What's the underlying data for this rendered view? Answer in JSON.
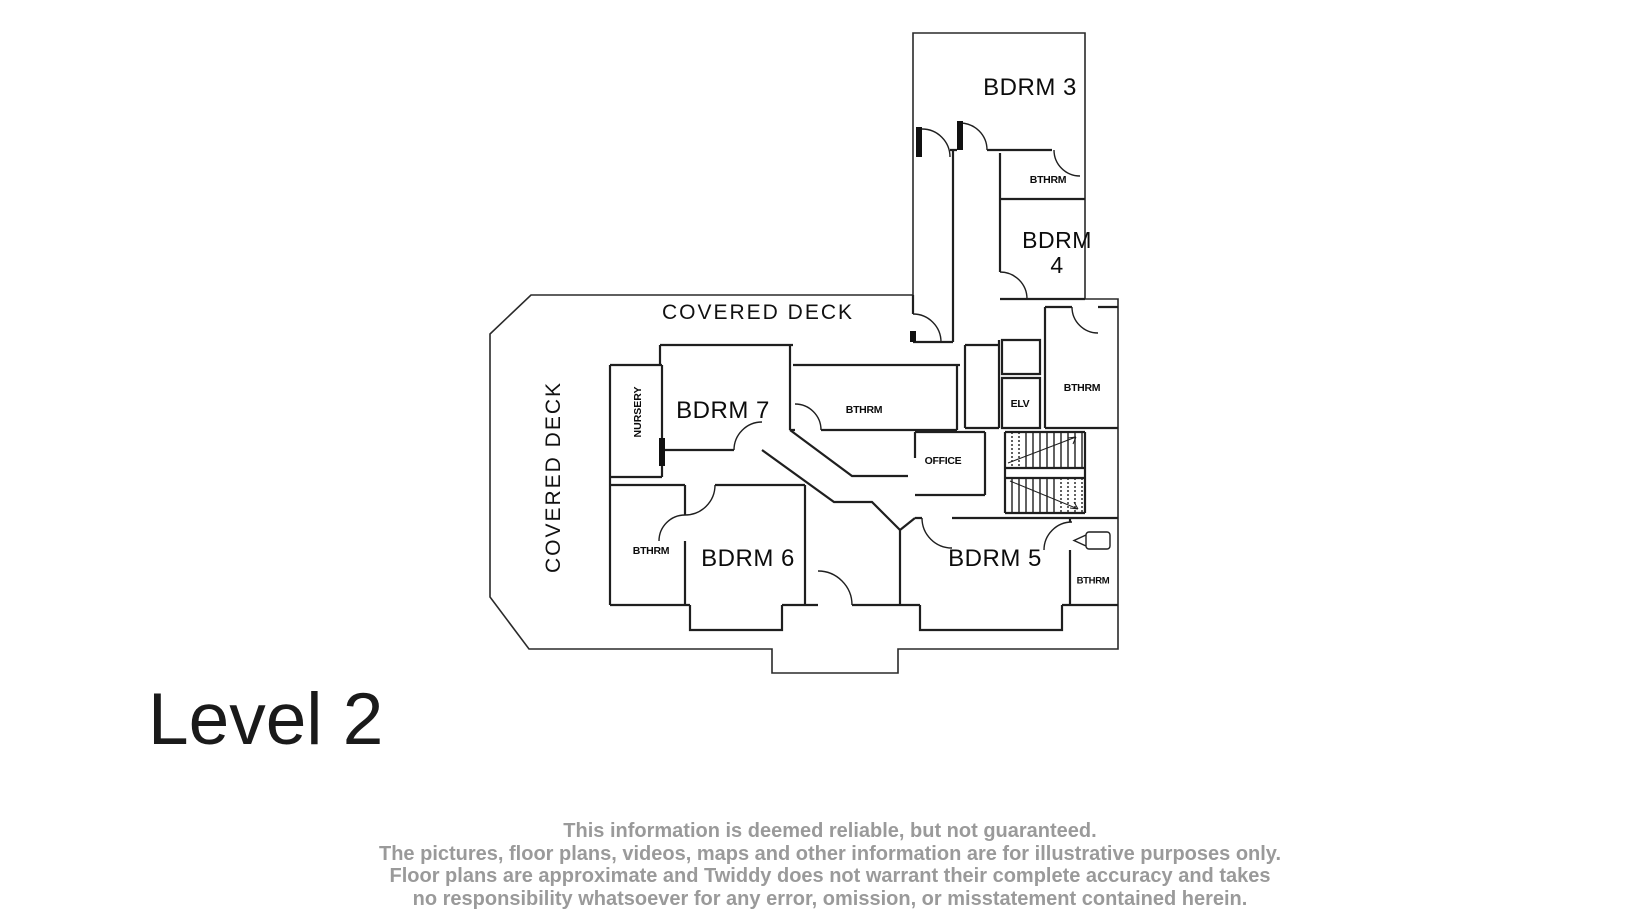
{
  "title": {
    "level_label": "Level 2"
  },
  "floor_plan": {
    "labels": {
      "bdrm3": "BDRM 3",
      "bthrm_top": "BTHRM",
      "bdrm4": "BDRM\n4",
      "elv": "ELV",
      "bthrm_upper_right": "BTHRM",
      "covered_deck_top": "COVERED DECK",
      "covered_deck_left": "COVERED DECK",
      "nursery": "NURSERY",
      "bdrm7": "BDRM 7",
      "bthrm_center": "BTHRM",
      "office": "OFFICE",
      "bthrm_left": "BTHRM",
      "bdrm6": "BDRM 6",
      "bdrm5": "BDRM 5",
      "bthrm_lower_right": "BTHRM"
    },
    "colors": {
      "wall": "#1f1f1f",
      "label": "#0c0c0c",
      "disclaimer_text": "#9a9a9a"
    }
  },
  "disclaimer": {
    "line1": "This information is deemed reliable, but not guaranteed.",
    "line2": "The pictures, floor plans, videos, maps and other information are for illustrative purposes only.",
    "line3": "Floor plans are approximate and Twiddy does not warrant their complete accuracy and takes",
    "line4": "no responsibility whatsoever for any error, omission, or misstatement contained herein."
  }
}
